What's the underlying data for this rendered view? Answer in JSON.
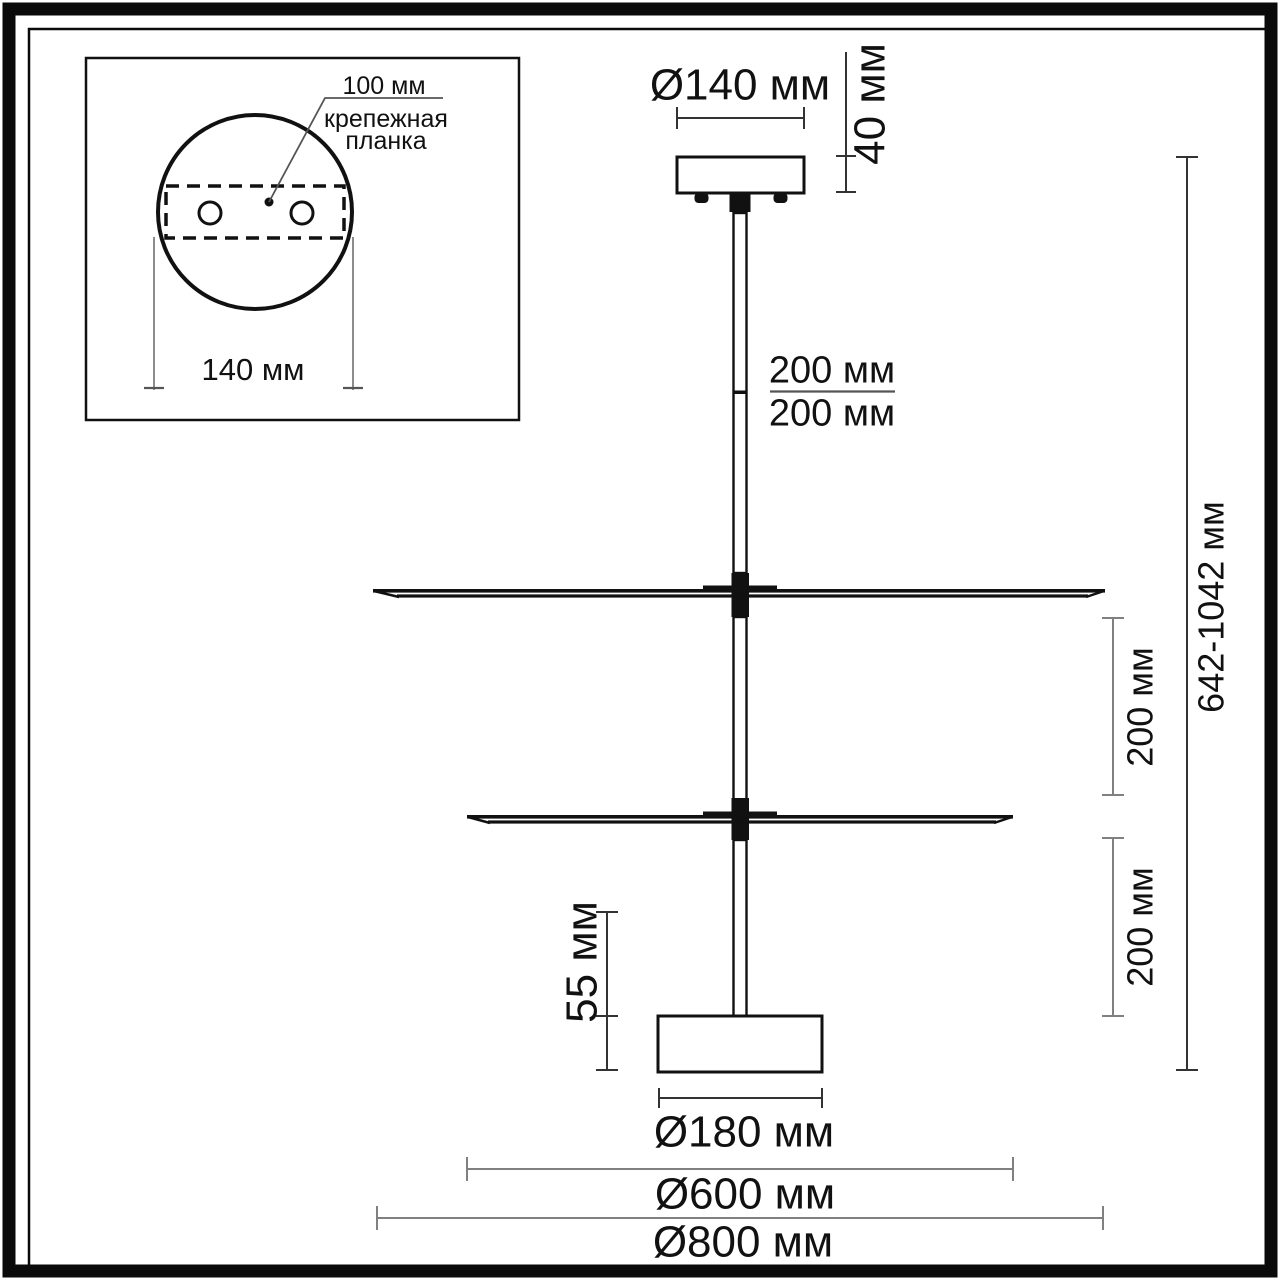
{
  "inset": {
    "hole_spacing": "100 мм",
    "mount_plate_line1": "крепежная",
    "mount_plate_line2": "планка",
    "canopy_width": "140 мм"
  },
  "dimensions": {
    "canopy_diameter": "Ø140 мм",
    "canopy_height": "40 мм",
    "rod_section_upper": "200 мм",
    "rod_section_lower": "200 мм",
    "overall_height": "642-1042 мм",
    "tier_gap_upper": "200 мм",
    "tier_gap_lower": "200 мм",
    "base_height": "55 мм",
    "base_diameter": "Ø180 мм",
    "disc_small_diameter": "Ø600 мм",
    "disc_large_diameter": "Ø800 мм"
  },
  "colors": {
    "ink": "#111111",
    "dim_dark": "#333333",
    "dim_gray": "#808080",
    "leader_gray": "#555555"
  }
}
